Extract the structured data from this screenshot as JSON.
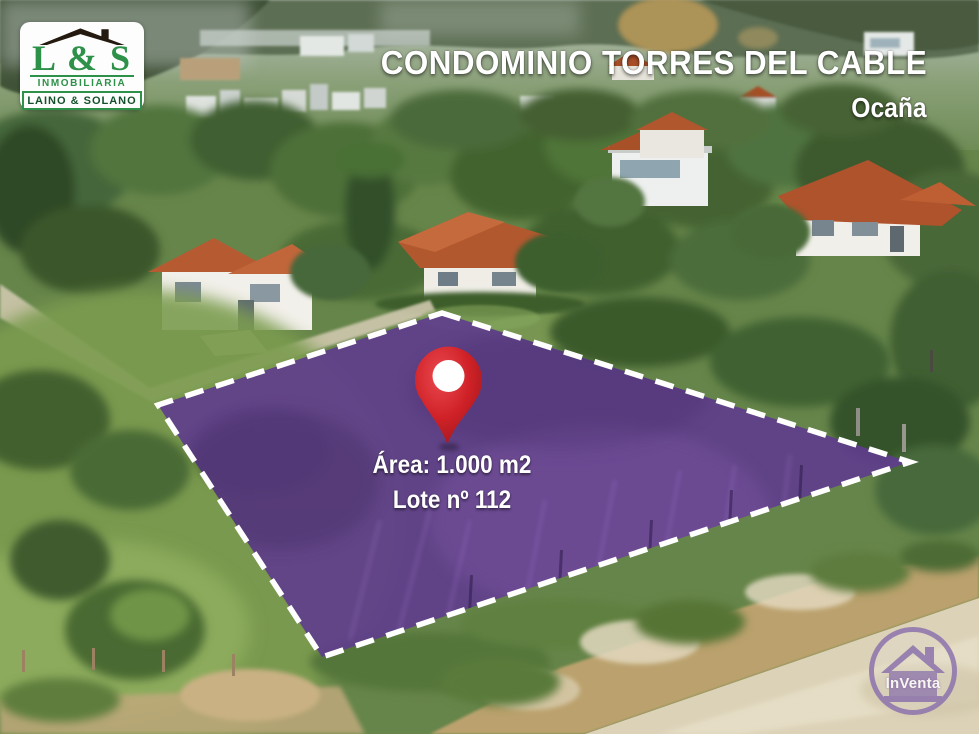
{
  "header": {
    "title": "CONDOMINIO TORRES DEL CABLE",
    "subtitle": "Ocaña"
  },
  "lot": {
    "area_label": "Área: 1.000 m2",
    "lote_label": "Lote nº 112"
  },
  "branding": {
    "ls": {
      "initials": "L & S",
      "line1": "INMOBILIARIA",
      "line2": "LAINO & SOLANO",
      "green": "#2e9149",
      "dark_green": "#14512a"
    },
    "inventa": {
      "label": "InVenta",
      "purple": "#8a70ad"
    }
  },
  "colors": {
    "lot_overlay": "#5f3c8e",
    "lot_border": "#ffffff",
    "pin_red": "#cf2127"
  }
}
